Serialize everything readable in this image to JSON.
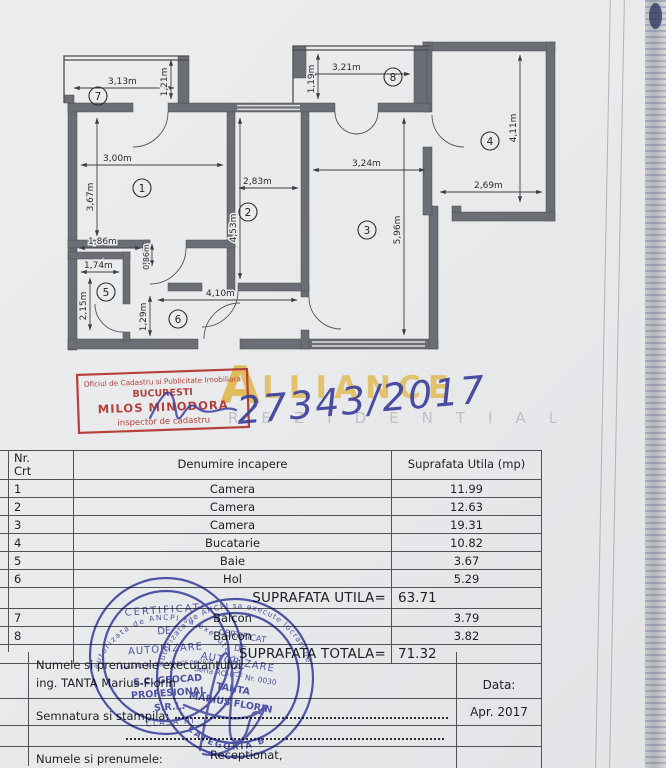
{
  "document": {
    "registration_number": "27343/2017"
  },
  "plan": {
    "room_numbers": {
      "n1": "1",
      "n2": "2",
      "n3": "3",
      "n4": "4",
      "n5": "5",
      "n6": "6",
      "n7": "7",
      "n8": "8"
    },
    "dims": {
      "r7w": "3,13m",
      "r7h": "1,21m",
      "r1w": "3,00m",
      "r1h": "3,67m",
      "r2w": "2,83m",
      "r2h": "4,53m",
      "r8w": "3,21m",
      "r8h": "1,19m",
      "r3w": "3,24m",
      "r3h": "5,96m",
      "r4w": "2,69m",
      "r4h": "4,11m",
      "r5w": "1,74m",
      "r5h": "2,15m",
      "nook_w": "1,86m",
      "nook_h": "0,86m",
      "r6w": "4,10m",
      "r6h": "1,29m"
    }
  },
  "watermark": {
    "brand_initial": "A",
    "brand_rest": "LLIANCE",
    "subtitle": "REZIDENTIAL",
    "gold": "#dfb64a"
  },
  "stamps": {
    "red": {
      "line1": "Oficiul de Cadastru si Publicitate Imobiliara",
      "line2": "BUCURESTI",
      "line3": "MILOS MINODORA",
      "line4": "inspector de cadastru",
      "color": "#b5403c"
    },
    "blue_left": {
      "ring_top": "autorizata de ANCPI sa execute lucrari",
      "title1": "CERTIFICAT",
      "title2": "DE",
      "title3": "AUTORIZARE",
      "serial": "Seria RO-B-J Nr. 0644/05.06.2016",
      "name1": "S.C. GEOCAD",
      "name2": "PROFESIONAL",
      "name3": "S.R.L.",
      "class_label": "CLASA III",
      "color": "#3d44a8"
    },
    "blue_right": {
      "ring_top": "autorizata de ANCPI sa execute lucrari de",
      "title1": "CERTIFICAT",
      "title2": "DE",
      "title3": "AUTORIZARE",
      "serial": "Seria RO-IF-F Nr. 0030",
      "name1": "TANTA",
      "name2": "MARIUS FLORIN",
      "ring_bottom": "CATEGORIA B",
      "color": "#3d44a8"
    }
  },
  "table": {
    "col_nr": "Nr. Crt",
    "col_name": "Denumire incapere",
    "col_area": "Suprafata Utila (mp)",
    "rows": [
      {
        "nr": "1",
        "name": "Camera",
        "area": "11.99"
      },
      {
        "nr": "2",
        "name": "Camera",
        "area": "12.63"
      },
      {
        "nr": "3",
        "name": "Camera",
        "area": "19.31"
      },
      {
        "nr": "4",
        "name": "Bucatarie",
        "area": "10.82"
      },
      {
        "nr": "5",
        "name": "Baie",
        "area": "3.67"
      },
      {
        "nr": "6",
        "name": "Hol",
        "area": "5.29"
      }
    ],
    "subtotal_label": "SUPRAFATA UTILA=",
    "subtotal_value": "63.71",
    "balcony_rows": [
      {
        "nr": "7",
        "name": "Balcon",
        "area": "3.79"
      },
      {
        "nr": "8",
        "name": "Balcon",
        "area": "3.82"
      }
    ],
    "total_label": "SUPRAFATA TOTALA=",
    "total_value": "71.32"
  },
  "footer": {
    "executant_label": "Numele si prenumele executantului:",
    "executant_name": "ing. TANTA Marius-Florin",
    "data_label": "Data:",
    "data_value": "Apr. 2017",
    "semnatura_label": "Semnatura si stampila:",
    "receptionat": "Receptionat,",
    "nume_label": "Numele si prenumele:"
  }
}
